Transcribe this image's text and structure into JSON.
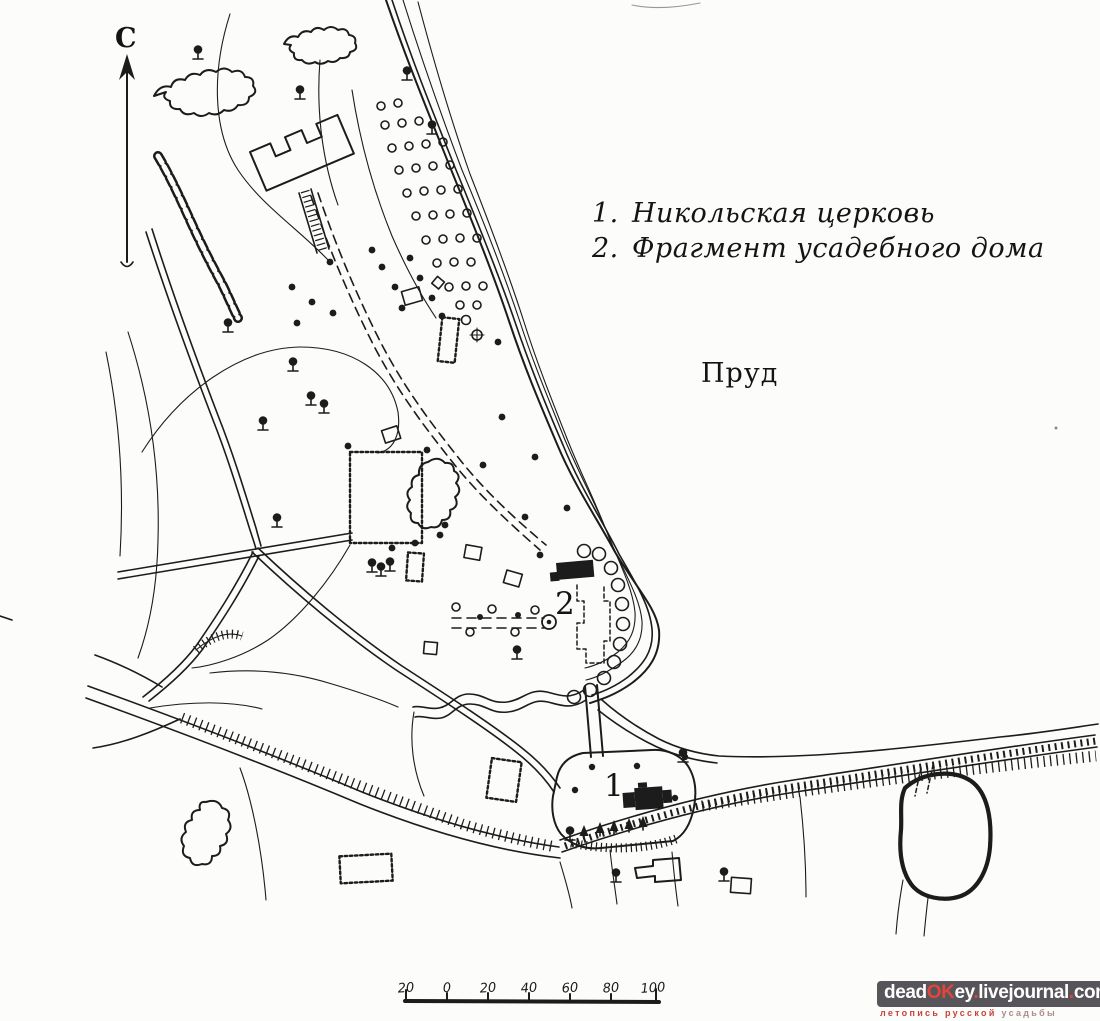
{
  "compass": {
    "label": "С"
  },
  "legend": {
    "items": [
      {
        "num": "1.",
        "label": "Никольская церковь"
      },
      {
        "num": "2.",
        "label": "Фрагмент усадебного дома"
      }
    ]
  },
  "map_labels": {
    "pond": "Пруд",
    "church_marker": "1",
    "manor_marker": "2"
  },
  "scale_bar": {
    "labels": [
      "20",
      "0",
      "20",
      "40",
      "60",
      "80",
      "100"
    ]
  },
  "watermark": {
    "site": {
      "p1": "dead",
      "p2": "OK",
      "p3": "ey",
      "p4": ".",
      "p5": "livejournal",
      "p6": ".",
      "p7": "com"
    },
    "tagline": {
      "red": "летопись русской",
      "muted": "усадьбы"
    }
  },
  "colors": {
    "ink": "#1c1c1c",
    "paper": "#fcfcfa",
    "accent_red": "#e2453a",
    "wm_bg": "#57555a"
  }
}
